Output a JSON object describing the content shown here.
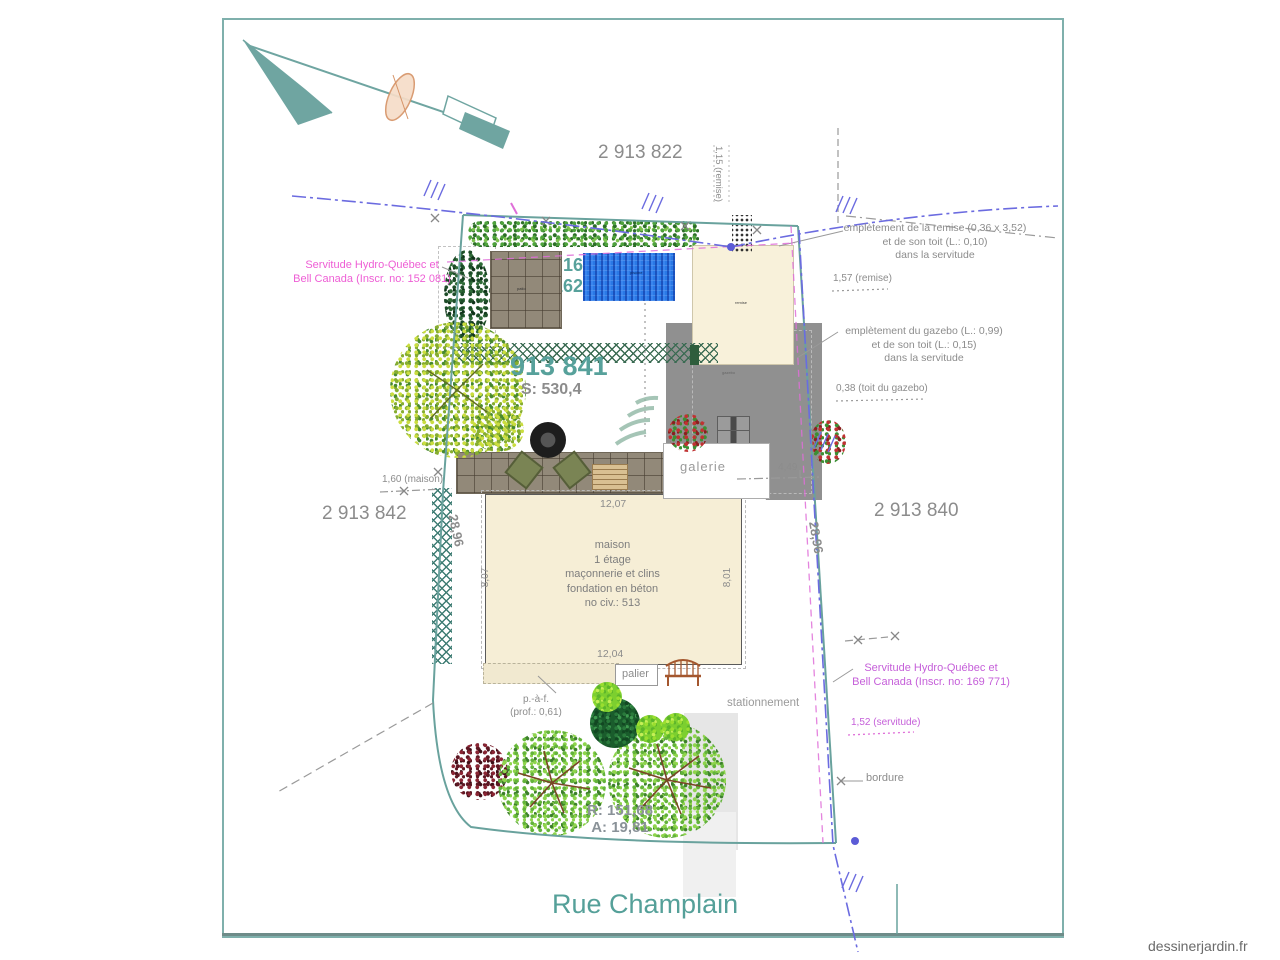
{
  "colors": {
    "teal_line": "#69a29d",
    "teal_text": "#57a19b",
    "gray_text": "#8c8c8c",
    "magenta_left": "#ee5ed5",
    "violet_right": "#c55fd9",
    "blue_utility": "#6b6be0",
    "house_fill": "#f6eed6",
    "pool_blue": "#2a79e6",
    "gazebo_gray": "#909090"
  },
  "lots": {
    "top": "2 913 822",
    "left": "2 913 842",
    "right": "2 913 840",
    "main": "913 841",
    "main_area": "S: 530,4",
    "clipped_line1": ": 16",
    "clipped_line2": "162"
  },
  "dimensions": {
    "left_side": "28,96",
    "right_side": "28,96",
    "house_top": "12,07",
    "house_bottom": "12,04",
    "house_left": "8,07",
    "house_right": "8,01",
    "galerie": "4,49"
  },
  "curve": {
    "radius": "R: 151,68",
    "arc": "A: 19,81"
  },
  "annotations": {
    "remise": {
      "line1": "emplètement de la remise (0,36 x 3,52)",
      "line2": "et de son toit (L.: 0,10)",
      "line3": "dans la servitude",
      "offset": "1,57 (remise)",
      "side": "1,15 (remise)"
    },
    "gazebo": {
      "line1": "emplètement du gazebo (L.: 0,99)",
      "line2": "et de son toit (L.: 0,15)",
      "line3": "dans la servitude",
      "roof": "0,38 (toit du gazebo)"
    },
    "servitude_left": {
      "line1": "Servitude Hydro-Québec et",
      "line2": "Bell Canada (Inscr. no: 152 081)"
    },
    "servitude_right": {
      "line1": "Servitude Hydro-Québec et",
      "line2": "Bell Canada (Inscr. no: 169 771)",
      "width": "1,52 (servitude)"
    },
    "maison_offset": "1,60 (maison)",
    "bordure": "bordure",
    "overhang": {
      "line1": "p.-à-f.",
      "line2": "(prof.: 0,61)"
    }
  },
  "house": {
    "line1": "maison",
    "line2": "1 étage",
    "line3": "maçonnerie et clins",
    "line4": "fondation en béton",
    "line5": "no civ.: 513"
  },
  "labels": {
    "galerie": "galerie",
    "palier": "palier",
    "stationnement": "stationnement",
    "street": "Rue Champlain",
    "watermark": "dessinerjardin.fr",
    "remise_tag": "remise",
    "gazebo_tag": "gazebo",
    "patio_tag": "patio",
    "pool_tag": "piscine"
  }
}
